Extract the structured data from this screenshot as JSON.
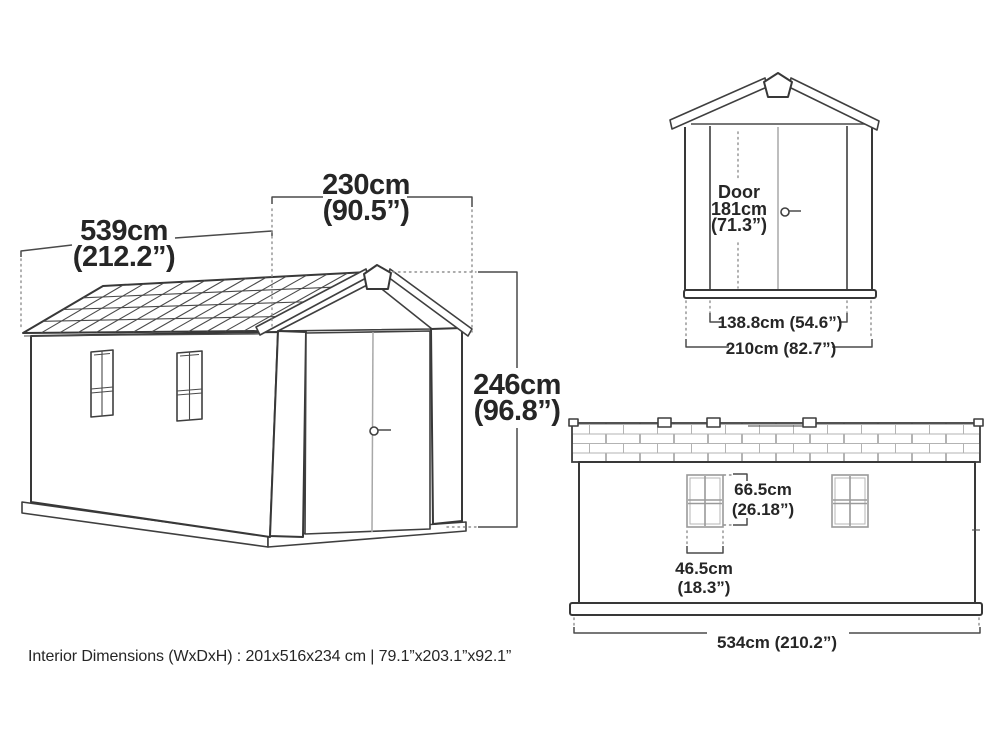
{
  "perspective_view": {
    "length_cm": "539cm",
    "length_in": "(212.2”)",
    "width_cm": "230cm",
    "width_in": "(90.5”)",
    "height_cm": "246cm",
    "height_in": "(96.8”)"
  },
  "front_view": {
    "door_label": "Door",
    "door_height_cm": "181cm",
    "door_height_in": "(71.3”)",
    "door_width": "138.8cm (54.6”)",
    "overall_width": "210cm (82.7”)"
  },
  "side_view": {
    "window_height_cm": "66.5cm",
    "window_height_in": "(26.18”)",
    "window_width_cm": "46.5cm",
    "window_width_in": "(18.3”)",
    "overall_length": "534cm (210.2”)"
  },
  "footer": {
    "interior_dimensions": "Interior Dimensions (WxDxH) : 201x516x234 cm | 79.1”x203.1”x92.1”"
  },
  "colors": {
    "line": "#383838",
    "light_line": "#a8a8a8",
    "dotted_line": "#8f8f8f",
    "text": "#262626",
    "background": "#ffffff"
  }
}
